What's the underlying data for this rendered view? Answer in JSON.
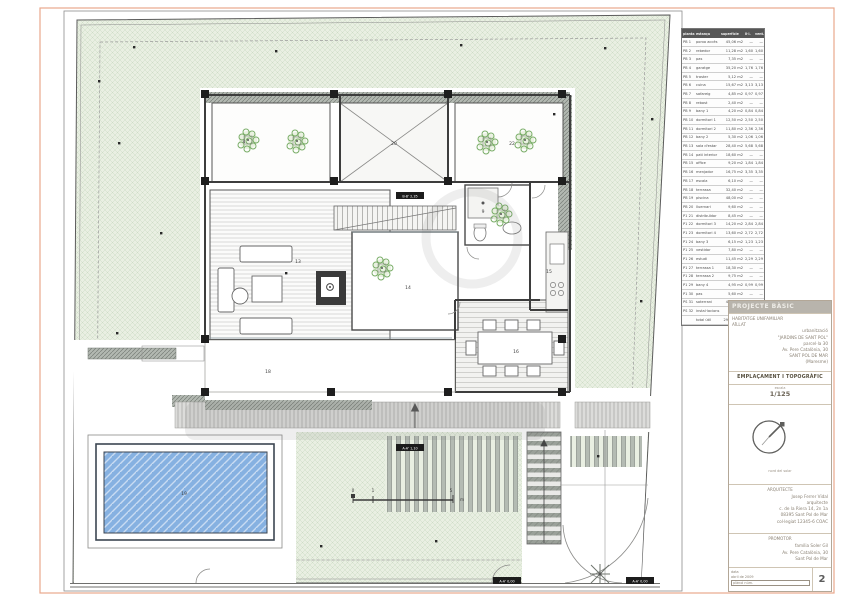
{
  "sheet": {
    "number": "2",
    "frame_color": "#e9a88d"
  },
  "schedule": {
    "headers": [
      "planta",
      "estança",
      "superfície",
      "il·l.",
      "vent."
    ],
    "rows": [
      [
        "PB 1",
        "porxo accés",
        "45,06 m2",
        "—",
        "—"
      ],
      [
        "PB 2",
        "rebedor",
        "11,28 m2",
        "1,60",
        "1,60"
      ],
      [
        "PB 3",
        "pas",
        "7,35 m2",
        "—",
        "—"
      ],
      [
        "PB 4",
        "garatge",
        "35,20 m2",
        "1,76",
        "1,76"
      ],
      [
        "PB 5",
        "traster",
        "5,12 m2",
        "—",
        "—"
      ],
      [
        "PB 6",
        "cuina",
        "15,67 m2",
        "3,13",
        "3,13"
      ],
      [
        "PB 7",
        "safareig",
        "4,85 m2",
        "0,97",
        "0,97"
      ],
      [
        "PB 8",
        "rebost",
        "2,40 m2",
        "—",
        "—"
      ],
      [
        "PB 9",
        "bany 1",
        "4,20 m2",
        "0,84",
        "0,84"
      ],
      [
        "PB 10",
        "dormitori 1",
        "12,50 m2",
        "2,50",
        "2,50"
      ],
      [
        "PB 11",
        "dormitori 2",
        "11,80 m2",
        "2,36",
        "2,36"
      ],
      [
        "PB 12",
        "bany 2",
        "5,30 m2",
        "1,06",
        "1,06"
      ],
      [
        "PB 13",
        "sala d'estar",
        "28,40 m2",
        "5,68",
        "5,68"
      ],
      [
        "PB 14",
        "pati interior",
        "18,60 m2",
        "—",
        "—"
      ],
      [
        "PB 15",
        "office",
        "9,20 m2",
        "1,84",
        "1,84"
      ],
      [
        "PB 16",
        "menjador",
        "16,75 m2",
        "3,35",
        "3,35"
      ],
      [
        "PB 17",
        "escala",
        "6,10 m2",
        "—",
        "—"
      ],
      [
        "PB 18",
        "terrassa",
        "32,40 m2",
        "—",
        "—"
      ],
      [
        "PB 19",
        "piscina",
        "48,00 m2",
        "—",
        "—"
      ],
      [
        "PB 20",
        "lluernari",
        "9,60 m2",
        "—",
        "—"
      ],
      [
        "P1 21",
        "distribuïdor",
        "8,45 m2",
        "—",
        "—"
      ],
      [
        "P1 22",
        "dormitori 3",
        "14,20 m2",
        "2,84",
        "2,84"
      ],
      [
        "P1 23",
        "dormitori 4",
        "13,60 m2",
        "2,72",
        "2,72"
      ],
      [
        "P1 24",
        "bany 3",
        "6,15 m2",
        "1,23",
        "1,23"
      ],
      [
        "P1 25",
        "vestidor",
        "7,80 m2",
        "—",
        "—"
      ],
      [
        "P1 26",
        "estudi",
        "11,45 m2",
        "2,29",
        "2,29"
      ],
      [
        "P1 27",
        "terrassa 1",
        "18,30 m2",
        "—",
        "—"
      ],
      [
        "P1 28",
        "terrassa 2",
        "9,75 m2",
        "—",
        "—"
      ],
      [
        "P1 29",
        "bany 4",
        "4,95 m2",
        "0,99",
        "0,99"
      ],
      [
        "P1 30",
        "pas",
        "5,60 m2",
        "—",
        "—"
      ],
      [
        "PS 31",
        "soterrani",
        "42,10 m2",
        "—",
        "—"
      ],
      [
        "PS 32",
        "instal·lacions",
        "8,90 m2",
        "—",
        "—"
      ],
      [
        "",
        "total útil",
        "298,45 m2",
        "—",
        "—"
      ]
    ]
  },
  "titleblock": {
    "phase": "PROJECTE BÀSIC",
    "project_lines": [
      "HABITATGE UNIFAMILIAR",
      "AÏLLAT",
      "urbanització",
      "\"JARDINS DE SANT POL\"",
      "parcel·la 30",
      "Av. Pere Catalònia, 30",
      "SANT POL DE MAR",
      "(Maresme)"
    ],
    "plan_title": "EMPLAÇAMENT I TOPOGRÀFIC",
    "scale_label": "escala",
    "scale_value": "1/125",
    "north_caption": "nord del solar",
    "architect_header": "ARQUITECTE",
    "architect_lines": [
      "Josep Ferrer Vidal",
      "arquitecte",
      "c. de la Riera 14, 2n 1a",
      "08395 Sant Pol de Mar",
      "col·legiat 12345-6 COAC"
    ],
    "promoter_header": "PROMOTOR",
    "promoter_lines": [
      "família Soler Gil",
      "Av. Pere Catalònia, 30",
      "Sant Pol de Mar"
    ],
    "footer_lines": [
      "data",
      "abril de 2009"
    ],
    "footer_box": "plànol núm.",
    "sheet_number": "2"
  },
  "plan": {
    "room_labels": [
      {
        "t": "4",
        "x": 244,
        "y": 143
      },
      {
        "t": "22",
        "x": 512,
        "y": 145
      },
      {
        "t": "20",
        "x": 394,
        "y": 145
      },
      {
        "t": "13",
        "x": 298,
        "y": 263
      },
      {
        "t": "14",
        "x": 408,
        "y": 289
      },
      {
        "t": "9",
        "x": 483,
        "y": 213
      },
      {
        "t": "15",
        "x": 549,
        "y": 273
      },
      {
        "t": "16",
        "x": 516,
        "y": 353
      },
      {
        "t": "18",
        "x": 268,
        "y": 373
      },
      {
        "t": "19",
        "x": 184,
        "y": 495
      }
    ],
    "section_marks": [
      {
        "t": "B-B' 2,35",
        "x": 410,
        "y": 196
      },
      {
        "t": "A-A' 1,10",
        "x": 410,
        "y": 448
      },
      {
        "t": "A-A' 0,00",
        "x": 507,
        "y": 581
      },
      {
        "t": "A-A' 0,00",
        "x": 640,
        "y": 581
      }
    ],
    "scalebar": {
      "zero": "0",
      "one": "1",
      "five": "5",
      "unit": "m"
    }
  }
}
